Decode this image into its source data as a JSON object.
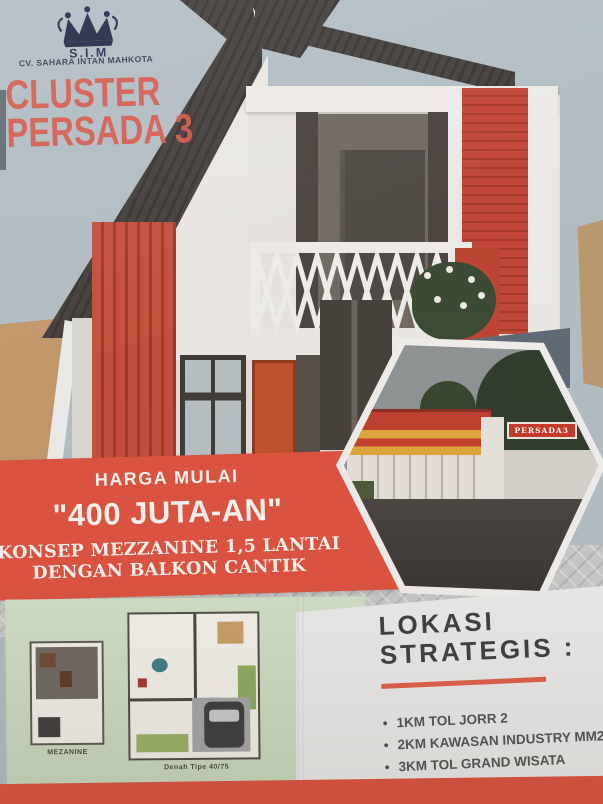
{
  "brand": {
    "abbr": "S.I.M",
    "company": "CV. SAHARA INTAN MAHKOTA"
  },
  "title": {
    "line1": "CLUSTER",
    "line2": "PERSADA 3"
  },
  "banner": {
    "label": "HARGA MULAI",
    "price": "\"400 JUTA-AN\"",
    "concept1": "KONSEP MEZZANINE 1,5 LANTAI",
    "concept2": "DENGAN BALKON CANTIK"
  },
  "gate_photo": {
    "sign": "PERSADA3"
  },
  "plans": {
    "mezzanine_label": "MEZANINE",
    "main_label": "Denah Tipe 40/75"
  },
  "location": {
    "heading1": "LOKASI",
    "heading2": "STRATEGIS :",
    "items": [
      "1KM TOL JORR 2",
      "2KM KAWASAN INDUSTRY MM2100",
      "3KM TOL GRAND WISATA",
      "2 MENIT PASAR SETU",
      "3 MENIT RS UMUM"
    ]
  },
  "colors": {
    "accent_red": "#df5140",
    "brick_red": "#c24434",
    "title_red": "#d95a4e",
    "panel_green": "#cfe0c8",
    "sky": "#b4c0c8"
  }
}
